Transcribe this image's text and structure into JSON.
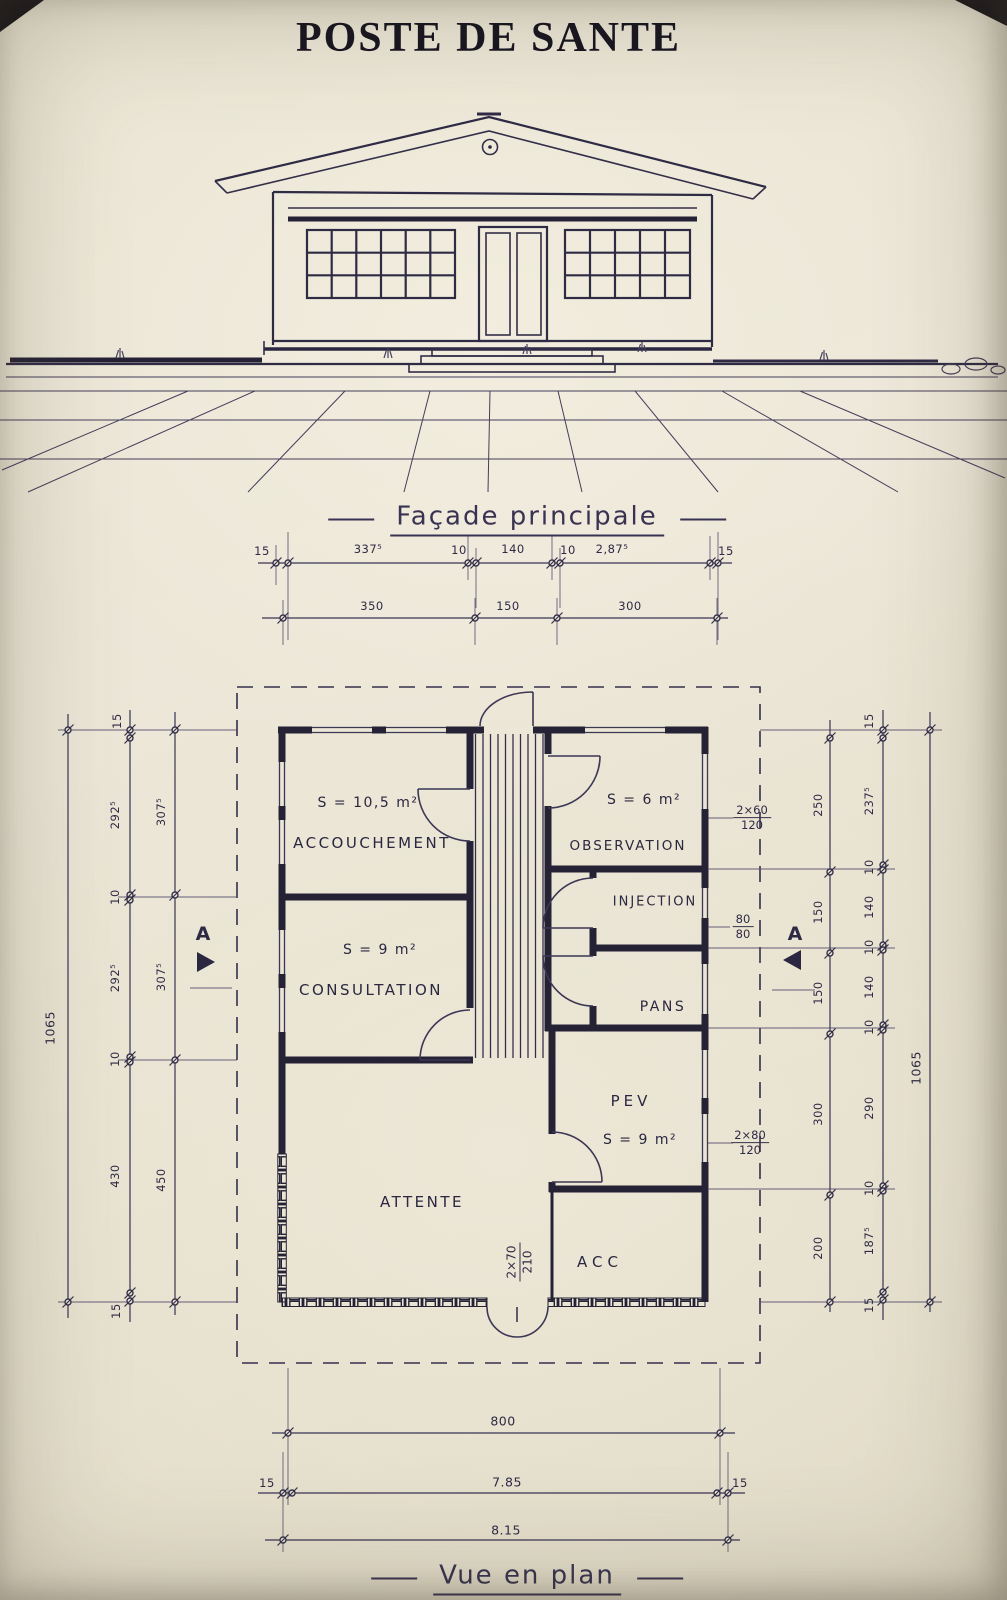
{
  "title": "POSTE DE SANTE",
  "facade": {
    "caption": "Façade principale",
    "dims_row1": [
      "15",
      "337⁵",
      "10",
      "140",
      "10",
      "2,87⁵",
      "15"
    ],
    "dims_row2": [
      "350",
      "150",
      "300"
    ]
  },
  "plan": {
    "caption": "Vue en plan",
    "section_mark": "A",
    "rooms": {
      "accouchement": {
        "area": "S = 10,5 m²",
        "name": "ACCOUCHEMENT"
      },
      "consultation": {
        "area": "S = 9 m²",
        "name": "CONSULTATION"
      },
      "observation": {
        "area": "S = 6 m²",
        "name": "OBSERVATION"
      },
      "injection": {
        "name": "INJECTION"
      },
      "pans": {
        "name": "PANS"
      },
      "pev": {
        "name": "PEV",
        "area": "S = 9 m²"
      },
      "attente": {
        "name": "ATTENTE"
      },
      "acc": {
        "name": "ACC"
      }
    },
    "openings": {
      "obs_window": {
        "num": "2×60",
        "den": "120"
      },
      "inj_window": {
        "num": "80",
        "den": "80"
      },
      "pev_window": {
        "num": "2×80",
        "den": "120"
      },
      "entry_door": {
        "num": "2×70",
        "den": "210"
      }
    }
  },
  "dims": {
    "left_total": "1065",
    "left_outer": [
      "15",
      "292⁵",
      "10",
      "292⁵",
      "10",
      "430",
      "15"
    ],
    "left_inner": [
      "307⁵",
      "307⁵",
      "450"
    ],
    "right_inner": [
      "250",
      "150",
      "150",
      "300",
      "200"
    ],
    "right_outer": [
      "15",
      "237⁵",
      "10",
      "140",
      "10",
      "140",
      "10",
      "290",
      "10",
      "187⁵",
      "15"
    ],
    "right_total": "1065",
    "bottom_800": "800",
    "bottom_row2": [
      "15",
      "7.85",
      "15"
    ],
    "bottom_815": "8.15"
  }
}
